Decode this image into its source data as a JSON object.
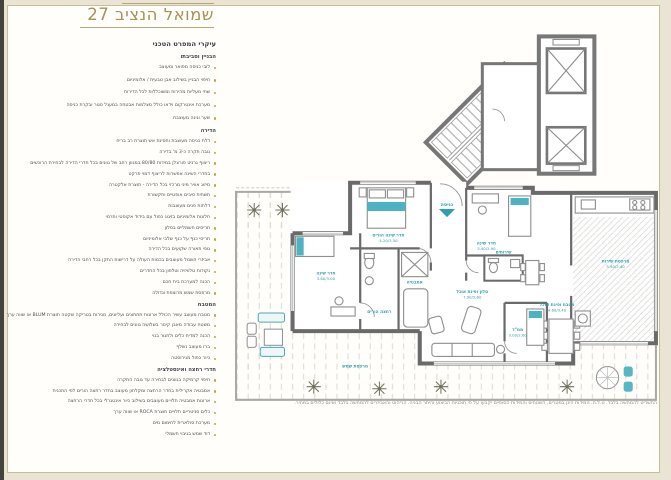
{
  "page": {
    "title": "שמואל הנציב 27",
    "subtitle": "עיקרי המפרט הטכני"
  },
  "colors": {
    "accent_gold": "#a89155",
    "bullet_gold": "#c8a33c",
    "label_teal": "#2f9fae",
    "wall_gray": "#6a6a6a",
    "page_cream": "#e9e4d3"
  },
  "specs": {
    "sections": [
      {
        "heading": "הבניין וסביבתו",
        "items": [
          "לובי כניסה מפואר ומעוצב",
          "חיפוי הבניין בשילוב אבן טבעית / אלומיניום",
          "שתי מעליות מהירות ומשוכללות לכל הדירות",
          "מערכת אינטרקום וידאו כולל מצלמות אבטחה במעגל סגור ובקרת כניסה",
          "שער וגינה מעוצבת"
        ]
      },
      {
        "heading": "הדירה",
        "items": [
          "דלת כניסה מעוצבת וחסינת אש תוצרת רב בריח",
          "גובה תקרה כ-3 מ' בדירה",
          "ריצוף גרניט פורצלן במידות 80/80 במגוון רחב של גוונים בכל חדרי הדירה לבחירת הרוכשים",
          "בחדרי השינה אפשרות לריצוף דמוי פרקט",
          "מיזוג אוויר מיני מרכזי בכל הדירה - תוצרת אלקטרה",
          "תשתית סיבים אופטיים ותקשורת",
          "דלתות פנים מעוצבות",
          "חלונות אלומיניום בזיגוג כפול עם בידוד אקוסטי ותרמי",
          "תריסים חשמליים בסלון",
          "תריסי כנף על כנף שלבי אלומיניום",
          "גופי תאורה שקועים בכל הדירה",
          "אביזרי חשמל מעוצבים בכמות העולה על דרישות התקן בכל רחבי הדירה",
          "נקודות טלוויזיה וטלפון בכל החדרים",
          "הכנה למערכת בית חכם",
          "מרפסת שמש מרוצפת וגדולה"
        ]
      },
      {
        "heading": "המטבח",
        "items": [
          "מטבח מעוצב עשיר הכולל ארונות תחתונים ועליונים, מגירות בטריקה שקטה תוצרת BLUM או שווה ערך",
          "משטח עבודה מאבן קיסר בשלושה גוונים לבחירה",
          "הכנה למדיח כלים ולתנור בנוי",
          "ברז מעוצב נשלף",
          "כיור כפול מנירוסטה"
        ]
      },
      {
        "heading": "חדרי רחצה ואינסטלציה",
        "items": [
          "חיפוי קרמיקה בגוונים לבחירה עד גובה התקרה",
          "אמבטיה אקרילית בחדר הרחצה ומקלחון מעוצב בחדר רחצה הורים לפי התכנית",
          "ארונות אמבטיה תלויים מעוצבים בשילוב כיור אינטגרלי בכל חדרי הרחצה",
          "כלים סניטריים תלויים תוצרת ROCA או שווה ערך",
          "מערכת סולארית לחימום מים",
          "דוד שמש בגיבוי חשמלי"
        ]
      }
    ]
  },
  "plan": {
    "entrance": "כניסה",
    "labels": {
      "master": {
        "name": "חדר שינה הורים",
        "dims": "4.20/3.50"
      },
      "bedroom2": {
        "name": "חדר שינה",
        "dims": "3.60/3.00"
      },
      "bedroom3": {
        "name": "חדר שינה",
        "dims": "3.40/2.90"
      },
      "mamad": {
        "name": "ממ\"ד",
        "dims": "3.00/2.60"
      },
      "living": {
        "name": "סלון ופינת אוכל",
        "dims": "7.90/5.60"
      },
      "kitchen": {
        "name": "מטבח ופינת אוכל",
        "dims": "4.60/3.40"
      },
      "service": {
        "name": "מרפסת שירות",
        "dims": "5.90/2.40"
      },
      "terrace": {
        "name": "מרפסת שמש"
      },
      "bath_parents": {
        "name": "רחצה הורים"
      },
      "bath": {
        "name": "אמבטיה"
      },
      "wc": {
        "name": "שירותים"
      }
    },
    "disclaimer": "התשריט להמחשה בלבד. ט.ל.ח. המידות הינן במטרים, השטחים והמידות הסופיים יקבעו על פי תוכניות הביצוע והיתר הבניה. הריהוט והאביזרים להמחשה בלבד ואינם כלולים במחיר."
  }
}
